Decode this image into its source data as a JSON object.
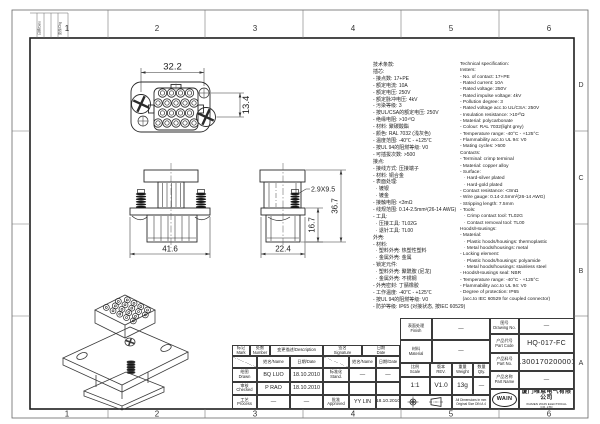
{
  "frame": {
    "zone_cols": [
      "1",
      "2",
      "3",
      "4",
      "5",
      "6"
    ],
    "zone_rows": [
      "D",
      "C",
      "B",
      "A"
    ],
    "corner_strip": {
      "c1": "日期/Date",
      "c2": "更改/Chg"
    }
  },
  "views": {
    "face": {
      "dim_width": "32.2",
      "dim_pitch": "13.4"
    },
    "front": {
      "dim_width": "41.6"
    },
    "side": {
      "dim_width": "22.4",
      "dim_lower": "16.7",
      "dim_total": "36.7",
      "callout": "2.9X9.5"
    }
  },
  "spec_cn": {
    "lines": [
      "技术条款:",
      "插芯:",
      "- 接点数: 17+PE",
      "- 额定电流: 10A",
      "- 额定电压: 250V",
      "- 额定脉冲电压: 4kV",
      "- 污染等级: 3",
      "- 按UL/CSA的额定电压: 250V",
      "- 绝缘电阻: >10¹⁰Ω",
      "- 材料: 聚碳酸酯",
      "- 颜色: RAL 7032 (浅灰色)",
      "- 温度范围: -40℃ - +125℃",
      "- 按UL 94的阻燃等级: V0",
      "- 可插拔次数: >500",
      "接点:",
      "- 接线方式: 压接端子",
      "- 材料: 铜合金",
      "- 表面处理:",
      "  · 镀银",
      "  · 镀金",
      "- 接触电阻: <3mΩ",
      "- 线规范围: 0.14-2.5mm²(26-14 AWG)",
      "- 工具:",
      "  · 压接工具: TL02G",
      "  · 退针工具: TL00",
      "外壳:",
      "- 材料:",
      "  · 塑料外壳: 热塑性塑料",
      "  · 金属外壳: 金属",
      "- 锁定元件:",
      "  · 塑料外壳: 聚酰胺 (尼龙)",
      "  · 金属外壳: 不锈钢",
      "- 外壳密封: 丁腈橡胶",
      "- 工作温度: -40℃ - +125℃",
      "- 按UL 94的阻燃等级: V0",
      "- 防护等级: IP65 (对接状态, 按IEC 60529)"
    ]
  },
  "spec_en": {
    "lines": [
      "Technical specification:",
      "Insters:",
      "- No. of contact: 17+PE",
      "- Rated current: 10A",
      "- Rated voltage: 250V",
      "- Rated impulse voltage: 4kV",
      "- Pollution degree: 3",
      "- Rated voltage acc.to UL/CSA: 250V",
      "- Insulation resistance: >10¹⁰Ω",
      "- Material: polycarbonate",
      "- Colour: RAL 7032(light grey)",
      "- Temperature range: -40°C - +125°C",
      "- Flammability acc.to UL 94: V0",
      "- Mating cycles: >500",
      "Contacts:",
      "- Terminal: crimp terminal",
      "- Material: copper alloy",
      "- Surface:",
      "   · Hard-silver plated",
      "   · Hard-gold plated",
      "- Contact resistance: <3mΩ",
      "- Wire gauge: 0.14-2.5mm²(26-14 AWG)",
      "- Stripping length: 7.5mm",
      "- Tools:",
      "   · Crimp contact tool: TL02G",
      "   · Contact removal tool: TL00",
      "Hoods/Housings:",
      "- Material:",
      "   · Plastic hoods/housings: thermoplastic",
      "   · Metal hoods/housings: metal",
      "- Locking element:",
      "   · Plastic hoods/housings: polyamide",
      "   · Metal hoods/housings: stainless steel",
      "- Hoods/Housings seal: NBR",
      "- Temperature range: -40°C - +125°C",
      "- Flammability acc.to UL 94: V0",
      "- Degree of protection: IP65",
      "  (acc.to IEC 60529 for coupled connector)"
    ]
  },
  "titleblock": {
    "mark_cn": "标记",
    "mark_en": "Mark",
    "number_cn": "处数",
    "number_en": "Number",
    "description": "变更描述/Description",
    "signature_cn": "签名",
    "signature_en": "Signature",
    "date_cn": "日期",
    "date_en": "Date",
    "name_header": "姓名/Name",
    "date_header": "日期/Date",
    "drawn_cn": "绘图",
    "drawn_en": "Drawn",
    "drawn_name": "BQ LUO",
    "drawn_date": "18.10.2010",
    "checked_cn": "审核",
    "checked_en": "Checked",
    "checked_name": "P RAO",
    "checked_date": "18.10.2010",
    "process_cn": "工艺",
    "process_en": "Process",
    "process_name": "—",
    "process_date": "—",
    "stand_cn": "标准化",
    "stand_en": "Stand.",
    "stand_sig": "—",
    "stand_date": "—",
    "approved_cn": "批准",
    "approved_en": "Approved",
    "approved_sig": "YY LIN",
    "approved_date": "18.10.2010",
    "finish_cn": "表面处理",
    "finish_en": "Finish",
    "finish_value": "—",
    "material_cn": "材料",
    "material_en": "Material",
    "material_value": "—",
    "scale_cn": "比例",
    "scale_en": "Scale",
    "scale_value": "1:1",
    "rev_cn": "版本",
    "rev_en": "REV.",
    "rev_value": "V1.0",
    "weight_cn": "重量",
    "weight_en": "Weight",
    "weight_value": "13g",
    "qty_cn": "数量",
    "qty_en": "Qty.",
    "qty_value": "—",
    "note_line1": "All Dimensions in mm",
    "note_line2": "Original Size DIN A 4",
    "drawing_no_cn": "图号",
    "drawing_no_en": "Drawing No.",
    "drawing_no_value": "—",
    "part_code_cn": "产品代号",
    "part_code_en": "Part Code",
    "part_code_value": "HQ-017-FC",
    "part_no_cn": "产品料号",
    "part_no_en": "Part No.",
    "part_no_value": "1300170200001",
    "part_name_cn": "产品名称",
    "part_name_en": "Part Name",
    "part_name_value": "—",
    "logo": "WAIN",
    "company_cn": "厦门唯恩电气有限公司",
    "company_en": "XIAMEN WAIN ELECTRICAL CO.,LTD"
  }
}
